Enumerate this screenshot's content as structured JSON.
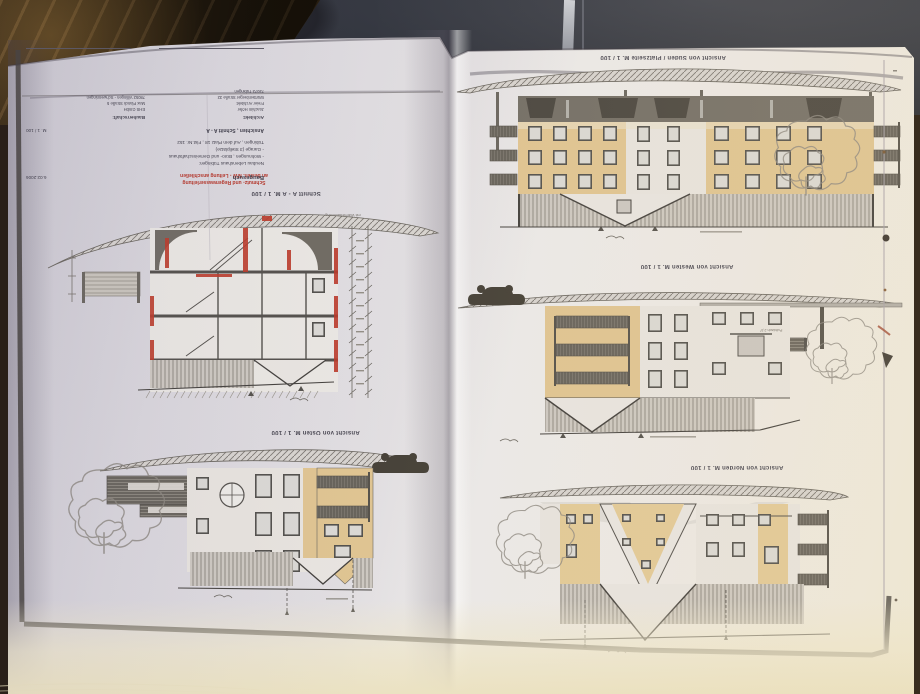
{
  "drawing_titles": {
    "sueden": "Ansicht von Süden / Platzseite  M. 1 / 100",
    "westen": "Ansicht von Westen  M. 1 / 100",
    "norden": "Ansicht von Norden  M. 1 / 100",
    "osten": "Ansicht von Osten  M. 1 / 100",
    "schnitt": "Schnitt A - A  M. 1 / 100"
  },
  "red_note": {
    "line1": "Schmutz- und Regenwasserleitung",
    "line2": "an besteh. MW - Leitung anschließen"
  },
  "annotations": {
    "daemmung": "mit Wärmedämmung",
    "pultdach": "Pultdach 2,5°"
  },
  "title_block": {
    "stage": "Baugesuch",
    "date": "6.02.2006",
    "project_lines": [
      "Neubau Lebenshaus Tübingen:",
      "- Wohnungen , Büro- und Gemeinschaftshaus",
      "- Garage (3 Stellplätze)",
      "Tübingen , Auf dem Platz 18 , Flst.Nr. 152"
    ],
    "sheet": "Ansichten , Schnitt A - A",
    "scale": "M. 1 / 100",
    "architect_header": "Architekt:",
    "architect_lines": [
      "Joachim Höfer",
      "Freier Architekt",
      "Württemberger Straße 32",
      "72072 Tübingen"
    ],
    "client_header": "Bauherrschaft:",
    "client_lines": [
      "EHS GmbH",
      "Max Planck Straße 5",
      "78052 Villingen - Schwenningen"
    ]
  },
  "colors": {
    "paper": "#e7e4e4",
    "facade_tan": "#dfc492",
    "line_dark": "#56534e",
    "band_dark": "#716c64",
    "red_accent": "#b5372b",
    "table_wood": "#33250f",
    "fabric": "#33363f",
    "cream_edge": "#ebe2c2"
  }
}
